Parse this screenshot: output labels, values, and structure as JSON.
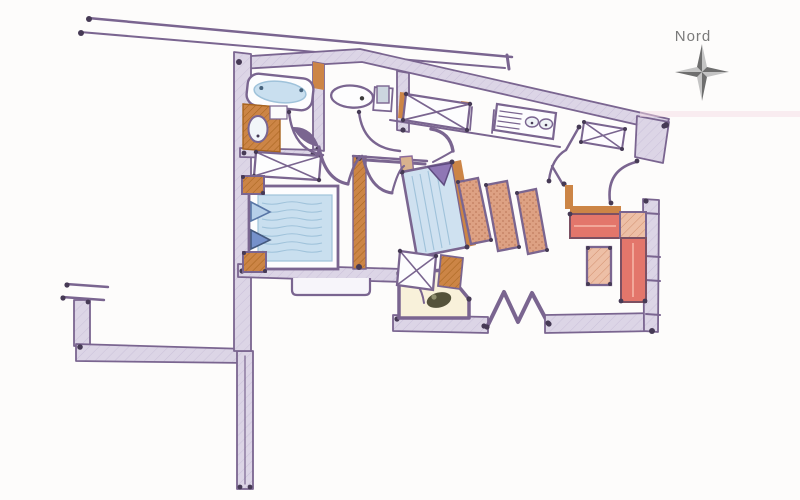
{
  "compass": {
    "label": "Nord"
  },
  "colors": {
    "paper": "#fdfcfb",
    "wall-stroke": "#7a6590",
    "wall-fill": "#dcd5e6",
    "wall-dark": "#463a55",
    "wall-hatch": "#cac0da",
    "orange": "#cc8546",
    "orange-dark": "#a8641f",
    "blue-fill": "#c9dfef",
    "blue-line": "#9fc2da",
    "pillow-light": "#b5cfe9",
    "pillow-dark": "#7591cb",
    "pillow-purple": "#8f77b5",
    "salmon": "#dda183",
    "salmon-dot": "#c07d5f",
    "red": "#e3766b",
    "red-light": "#f2a89a",
    "hatch-pink": "#edbfa6",
    "hatch-pink-line": "#d3906f",
    "cream": "#f8f1da",
    "blob-olive": "#54523a",
    "compass-dark": "#6e6e6e",
    "compass-light": "#c4c4c4",
    "compass-text": "#7a7a7a",
    "pink-smudge": "#f5dce6"
  }
}
